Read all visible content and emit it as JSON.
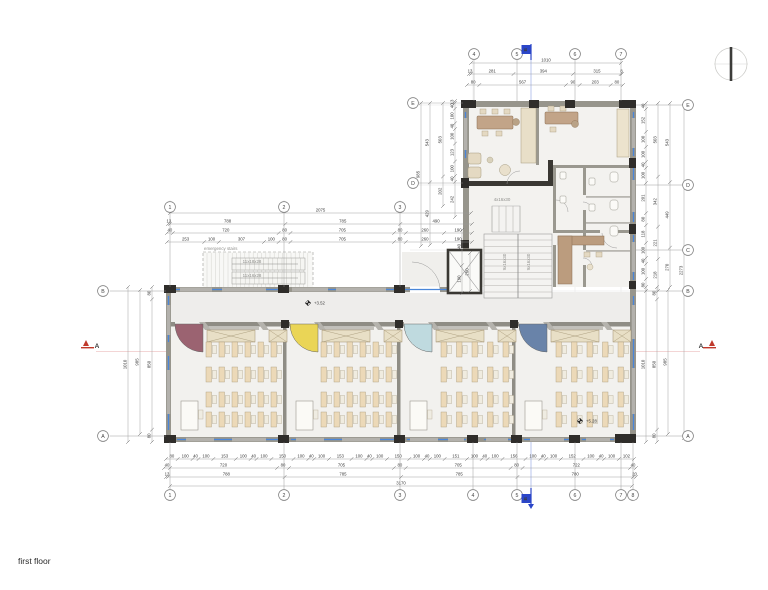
{
  "page": {
    "title": "first floor"
  },
  "colors": {
    "glazing": "#4a86d8",
    "wall": "#97958c",
    "column": "#2f2d2a",
    "section_a": "#c0392b",
    "section_b": "#2b46c8",
    "fan_room1": "#8e4f60",
    "fan_room2": "#e8d041",
    "fan_room3": "#b7d6dd",
    "fan_room4": "#55739f"
  },
  "section_markers": {
    "a": "A",
    "b": "B"
  },
  "levels": {
    "corridor": "+3.52",
    "classroom4": "+5.28"
  },
  "stairs": {
    "emergency_label": "emergency stairs",
    "emergency_flight_top": "11x18x28",
    "emergency_flight_bottom": "11x16x28",
    "hall_stair": "4x16x30",
    "flight_left": "9x16x30",
    "flight_right": "9x16x30"
  },
  "grid": {
    "top_main": [
      "1",
      "2",
      "3"
    ],
    "top_upper": [
      "4",
      "5",
      "6",
      "7"
    ],
    "bottom": [
      "1",
      "2",
      "3",
      "4",
      "5",
      "6",
      "7",
      "8"
    ],
    "left_main": [
      "B",
      "A"
    ],
    "left_upper": [
      "E",
      "D"
    ],
    "right": [
      "E",
      "D",
      "C",
      "B",
      "A"
    ]
  },
  "classrooms": [
    {
      "name": "classroom 1",
      "fan_color": "#8e4f60",
      "desk_columns": 6,
      "desk_rows": 4
    },
    {
      "name": "classroom 2",
      "fan_color": "#e8d041",
      "desk_columns": 6,
      "desk_rows": 4
    },
    {
      "name": "classroom 3",
      "fan_color": "#b7d6dd",
      "desk_columns": 5,
      "desk_rows": 4
    },
    {
      "name": "classroom 4",
      "fan_color": "#55739f",
      "desk_columns": 5,
      "desk_rows": 4
    }
  ],
  "dimensions": {
    "tu1": [
      "1010"
    ],
    "tu2": [
      "13",
      "281",
      "394",
      "315",
      "8"
    ],
    "tu3": [
      "80",
      "567",
      "90",
      "203",
      "80"
    ],
    "tm1": [
      "2075"
    ],
    "tm2": [
      "13",
      "788",
      "785",
      "490"
    ],
    "tm3": [
      "40",
      "720",
      "80",
      "705",
      "80",
      "260",
      "190"
    ],
    "tm4": [
      "253",
      "100",
      "307",
      "100",
      "80",
      "705",
      "80",
      "260",
      "190"
    ],
    "bm1": [
      "80",
      "100",
      "40",
      "100",
      "153",
      "100",
      "40",
      "100",
      "150",
      "100",
      "40",
      "100",
      "153",
      "100",
      "40",
      "100",
      "150",
      "100",
      "40",
      "100",
      "151",
      "100",
      "40",
      "100",
      "156",
      "100",
      "40",
      "100",
      "152",
      "100",
      "40",
      "100",
      "102"
    ],
    "bm2": [
      "40",
      "720",
      "80",
      "705",
      "80",
      "705",
      "80",
      "722",
      "40"
    ],
    "bm3": [
      "13",
      "788",
      "785",
      "785",
      "780",
      "20"
    ],
    "bm4": [
      "3170"
    ],
    "lm1": [
      "1010"
    ],
    "lm2": [
      "985"
    ],
    "lm3": [
      "80",
      "850",
      "80"
    ],
    "rm1": [
      "1010"
    ],
    "rm2": [
      "80",
      "850",
      "80"
    ],
    "rm3": [
      "985"
    ],
    "ru1": [
      "40",
      "152",
      "100",
      "100",
      "40",
      "100",
      "201",
      "80",
      "118",
      "100",
      "40",
      "100",
      "80"
    ],
    "ru2": [
      "503",
      "342",
      "221",
      "218"
    ],
    "ru3": [
      "543",
      "449",
      "270"
    ],
    "ru4": [
      "2273"
    ],
    "lu1": [
      "985"
    ],
    "lu2": [
      "543",
      "429"
    ],
    "lu3": [
      "503",
      "202"
    ],
    "lu4": [
      "13",
      "40",
      "100",
      "40",
      "100",
      "123",
      "100",
      "40",
      "242"
    ],
    "sx1": [
      "240",
      "190"
    ],
    "sx2": [
      "260"
    ]
  }
}
